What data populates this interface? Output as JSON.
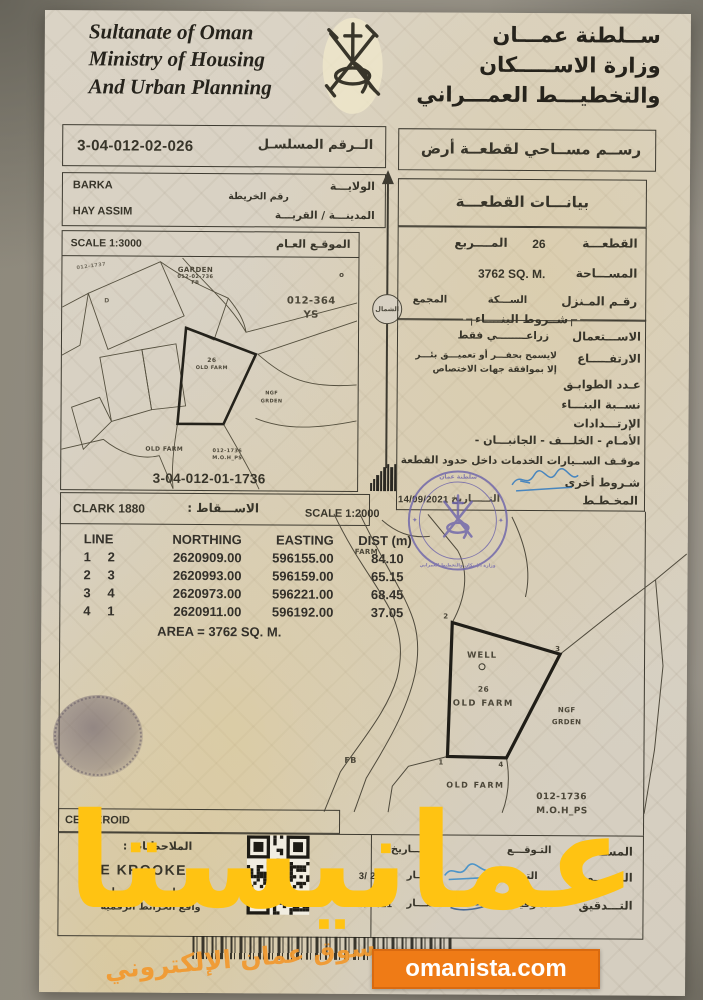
{
  "header": {
    "en1": "Sultanate of Oman",
    "en2": "Ministry of Housing",
    "en3": "And Urban Planning",
    "ar1": "ســلطنة عمـــان",
    "ar2": "وزارة الاســـــكان",
    "ar3": "والتخطيـــط العمـــراني"
  },
  "serial": {
    "label": "الــرقم المسلسـل",
    "value": "3-04-012-02-026"
  },
  "doc_title": "رســم مســاحي لقطعــة أرض",
  "location": {
    "wilaya_value": "BARKA",
    "village_value": "HAY ASSIM",
    "wilaya_label": "الولايـــة",
    "map_no_label": "رقم الخريطة",
    "city_label": "المدينـــة / القريـــة"
  },
  "plot_header": "بيانـــات القطعـــة",
  "site_map": {
    "scale": "SCALE 1:3000",
    "label": "الموقـع العـام",
    "serial": "3-04-012-01-1736",
    "garden": "GARDEN",
    "garden_no": "012-02-736",
    "garden_fb": "FB",
    "corner_mark": "o",
    "corner_ref": "012-1737",
    "d_mark": "D",
    "sector": "012-364",
    "sector_ys": "YS",
    "plot_no": "26",
    "plot_name": "OLD FARM",
    "ngf1": "NGF",
    "ngf2": "GRDEN",
    "bottom_farm": "OLD FARM",
    "ref1": "012-1736",
    "ref2": "M.O.H_PS"
  },
  "north_label": "الشمال",
  "plot": {
    "no_label": "القطعـــة",
    "no_value": "26",
    "square_label": "المــــربع",
    "area_label": "المســـاحة",
    "area_value": "3762 SQ. M.",
    "house_label": "رقـم المـنزل",
    "street_label": "الســـكة",
    "complex_label": "المجمع",
    "cond_title": "شــروط البنــــاء",
    "use_label": "الاســـتعمال",
    "use_value": "زراعــــــــي فقط",
    "height_label": "الارتفـــــاع",
    "height_note1": "لايسمح بحفـــر أو تعميـــق بئـــر",
    "height_note2": "إلا بموافقة جهات الاختصاص",
    "floors_label": "عـدد الطوابـق",
    "ratio_label": "نســبة البنـــاء",
    "setbacks_label": "الإرتـــدادات",
    "sides": "الأمـام   -   الخلـــف   -   الجانبـــان   -",
    "parking": "موقـف الســيارات الخدمات داخل حدود القطعة",
    "other": "شـروط أخرى",
    "planner_label": "المخـطـط",
    "date_label": "التـــــاريخ",
    "date": "14/09/2021"
  },
  "projection": {
    "label": "الاســـقاط :",
    "value": "CLARK 1880"
  },
  "survey_scale": "SCALE 1:2000",
  "stamp": {
    "line1": "سلطنة عمان",
    "line2": "وزارة الإسكان والتخطيط العمراني"
  },
  "coords": {
    "h_line": "LINE",
    "h_northing": "NORTHING",
    "h_easting": "EASTING",
    "h_dist": "DIST (m)",
    "rows": [
      {
        "from": "1",
        "to": "2",
        "northing": "2620909.00",
        "easting": "596155.00",
        "dist": "84.10"
      },
      {
        "from": "2",
        "to": "3",
        "northing": "2620993.00",
        "easting": "596159.00",
        "dist": "65.15"
      },
      {
        "from": "3",
        "to": "4",
        "northing": "2620973.00",
        "easting": "596221.00",
        "dist": "68.45"
      },
      {
        "from": "4",
        "to": "1",
        "northing": "2620911.00",
        "easting": "596192.00",
        "dist": "37.05"
      }
    ],
    "area": "AREA = 3762 SQ. M."
  },
  "survey_map": {
    "farm": "FARM",
    "well": "WELL",
    "plot_no": "26",
    "old_farm": "OLD FARM",
    "ngf1": "NGF",
    "ngf2": "GRDEN",
    "fb": "FB",
    "old_farm2": "OLD FARM",
    "ref1": "012-1736",
    "ref2": "M.O.H_PS",
    "v1": "1",
    "v2": "2",
    "v3": "3",
    "v4": "4"
  },
  "bottom": {
    "centeroid": "CENTEROID",
    "notes_label": "الملاحظـات :",
    "re_text": "RE KROOKE",
    "note1": "الاصدار رسم المساحي",
    "note2": "واقع الخرائط الرقمية",
    "r1_label": "المســـاح",
    "r1_mid": "التـوقـــع",
    "r1_left": "التـــاريخ",
    "r2_label": "الرســـم",
    "r2_mid": "التوقيع",
    "r2_tag": "TR",
    "r2_left": "التـــار",
    "r2_date": "3/ 2021",
    "r3_label": "التـــدقيق",
    "r3_mid": "التوقيـــب",
    "r3_left": "التـــار",
    "r3_date": "3/ 2021"
  },
  "watermark": {
    "big": "عمانيستا",
    "footer_ar": "سوق عمان الإلكتروني",
    "site": "omanista.com"
  },
  "colors": {
    "accent_orange": "#ef7b16",
    "watermark_yellow": "#ffc312",
    "emblem_red": "#b8392a",
    "stamp_purple": "#6c63ab"
  }
}
